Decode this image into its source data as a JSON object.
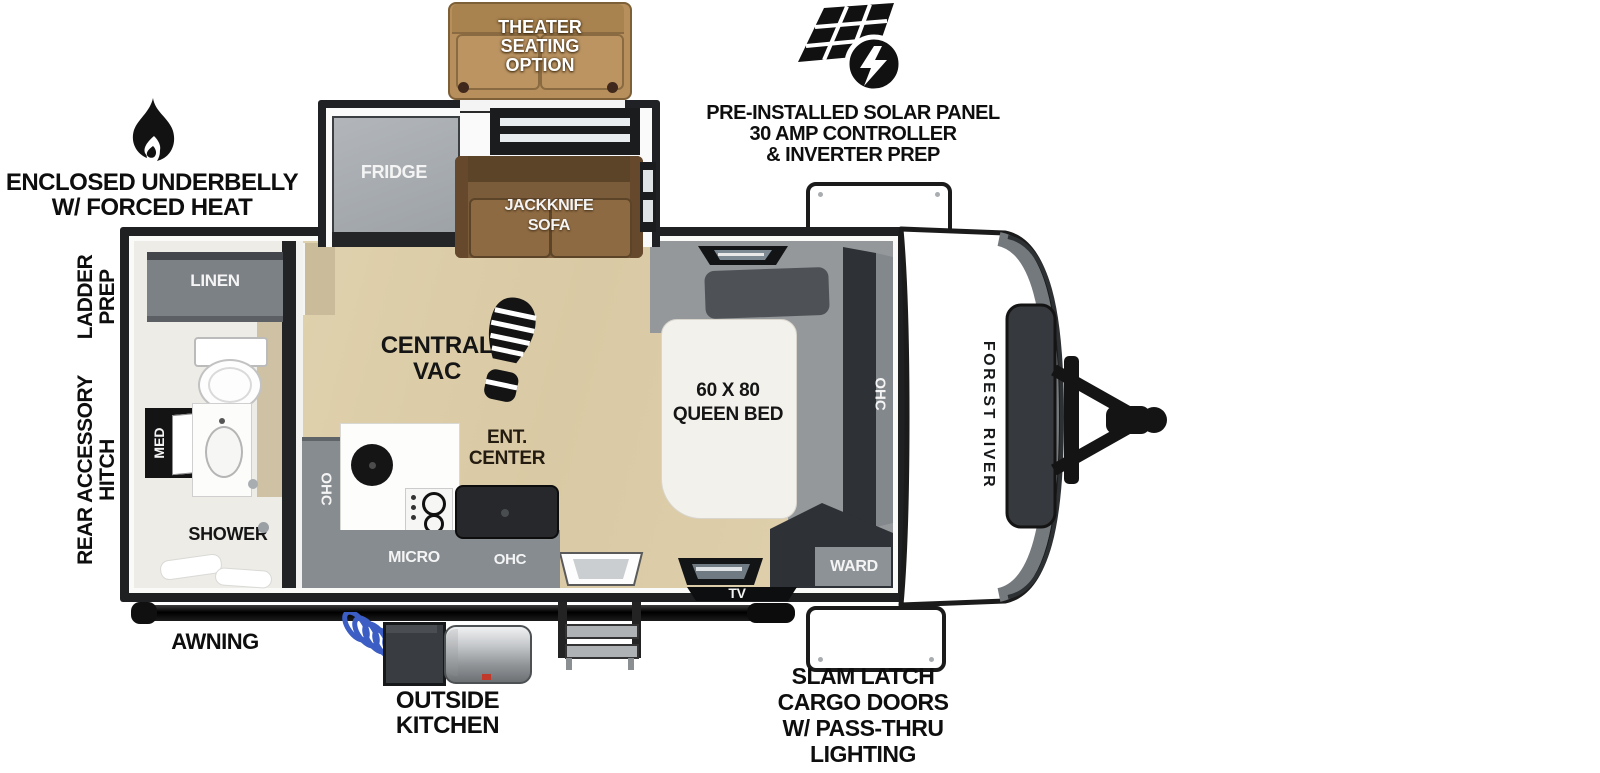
{
  "callouts": {
    "theater": {
      "lines": [
        "THEATER",
        "SEATING",
        "OPTION"
      ]
    },
    "solar": {
      "lines": [
        "PRE-INSTALLED SOLAR PANEL",
        "30 AMP CONTROLLER",
        "& INVERTER PREP"
      ]
    },
    "underbelly": {
      "lines": [
        "ENCLOSED UNDERBELLY",
        "W/ FORCED HEAT"
      ]
    },
    "ladder_prep": {
      "lines": [
        "LADDER",
        "PREP"
      ]
    },
    "rear_hitch": {
      "lines": [
        "REAR ACCESSORY",
        "HITCH"
      ]
    },
    "awning": {
      "label": "AWNING"
    },
    "outside_kitchen": {
      "lines": [
        "OUTSIDE",
        "KITCHEN"
      ]
    },
    "cargo": {
      "lines": [
        "SLAM LATCH",
        "CARGO DOORS",
        "W/ PASS-THRU",
        "LIGHTING"
      ]
    }
  },
  "rooms": {
    "linen": "LINEN",
    "med": "MED",
    "shower": "SHOWER",
    "fridge": "FRIDGE",
    "sofa_lines": [
      "JACKKNIFE",
      "SOFA"
    ],
    "central_vac": [
      "CENTRAL",
      "VAC"
    ],
    "ent_center": [
      "ENT.",
      "CENTER"
    ],
    "ohc_left": "OHC",
    "micro": "MICRO",
    "ohc_bottom": "OHC",
    "bed": [
      "60 X 80",
      "QUEEN BED"
    ],
    "ohc_bedroom": "OHC",
    "ward": "WARD",
    "tv": "TV"
  },
  "brand": {
    "name": "FOREST RIVER"
  },
  "colors": {
    "wall": "#1f2022",
    "floor_tan": "#dccda9",
    "counter_gray": "#878c91",
    "sofa_brown": "#7a5b3a",
    "theater_tan": "#b68f5c",
    "bed_white": "#f3f1eb",
    "hose_blue": "#3b5dc4",
    "callout_text": "#0e0e0e",
    "label_on_dark": "#f4f4f4"
  }
}
